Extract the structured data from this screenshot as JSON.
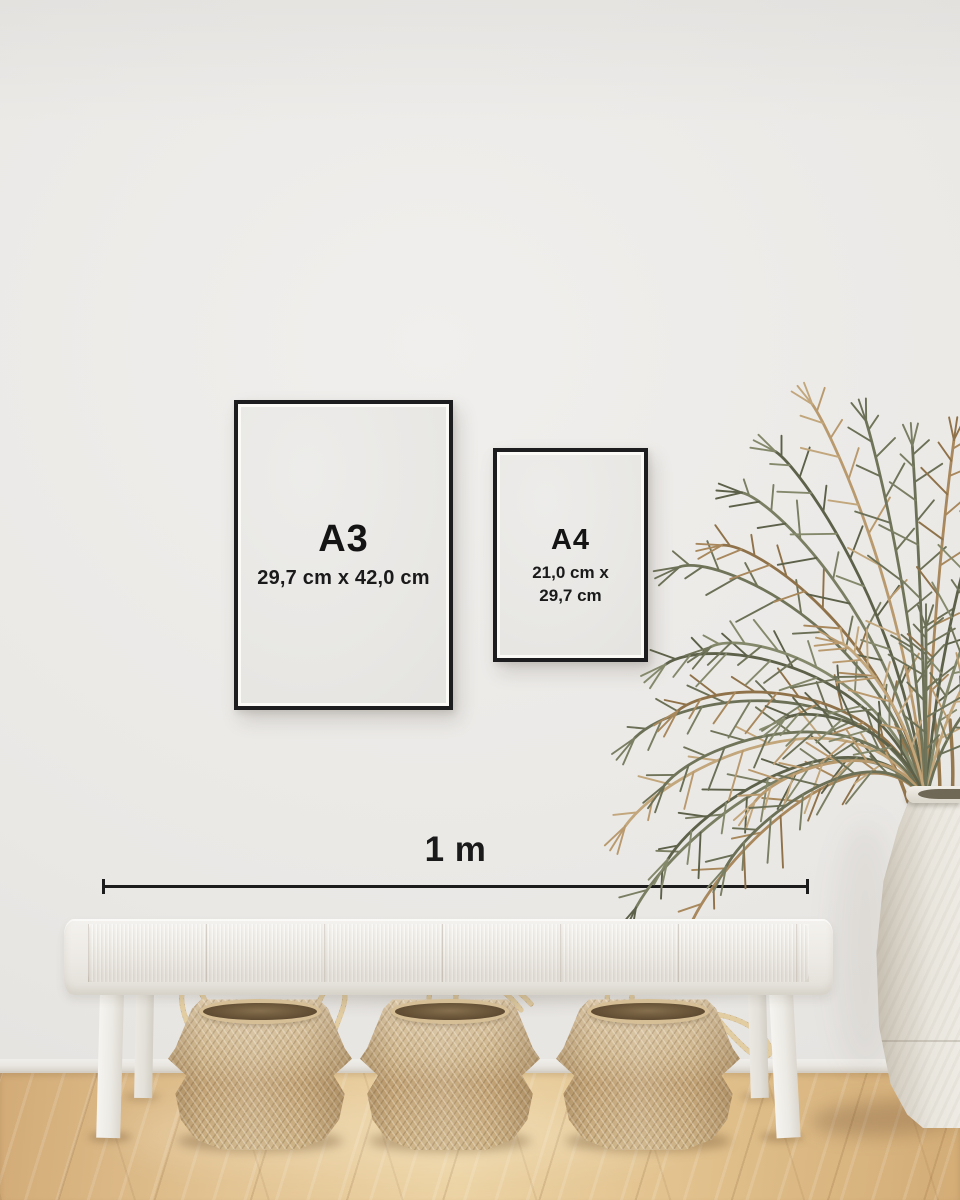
{
  "frames": {
    "a3": {
      "label": "A3",
      "dimensions": "29,7 cm x 42,0 cm"
    },
    "a4": {
      "label": "A4",
      "dimensions_line1": "21,0 cm x",
      "dimensions_line2": "29,7 cm"
    }
  },
  "scale_bar": {
    "label": "1 m"
  },
  "colors": {
    "frame_border": "#1d1d1f",
    "poster_background": "#e8e7e4",
    "text": "#161616",
    "wall": "#eae8e5",
    "floor_wood": "#ddba89",
    "bench_white": "#f0eeea",
    "basket_tan": "#ccb289",
    "plant_green": "#6b7056",
    "plant_brown": "#a8885c",
    "vase_white": "#e9e6df"
  }
}
